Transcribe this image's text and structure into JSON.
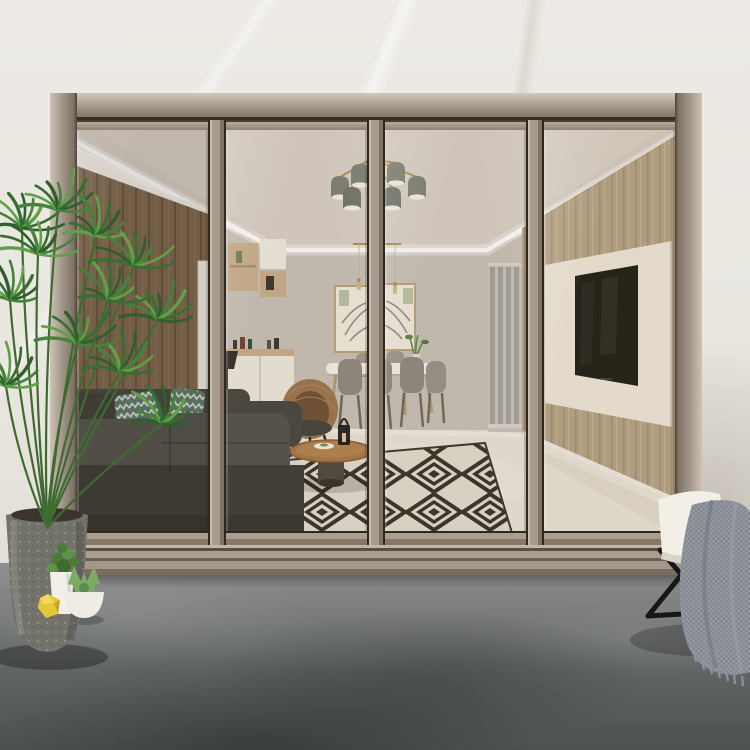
{
  "labels": {
    "scene": "Bronze aluminium four-panel sliding glass patio door looking into a modern living and dining room",
    "door_frame": "champagne bronze aluminium sliding door frame",
    "glass_panels": "tinted glass door panels",
    "living_room": "living room interior with sofa, rug, dining set, TV wall and cove-lit ceiling",
    "sofa": "dark grey fabric sofa with patterned cushions",
    "rug": "black and white geometric diamond rug",
    "dining_set": "white dining table with grey chairs and botanical wall art",
    "tv_wall": "oak panelled wall with white board and black TV",
    "chandelier": "six-shade grey and brass chandelier",
    "palm_plant": "potted areca palm on the patio",
    "small_plants": "small potted plant, succulent bowl and yellow decor",
    "patio_chair": "white-cushion chair with grey knit throw blanket",
    "patio_floor": "grey concrete patio floor",
    "exterior_wall": "light marble exterior wall"
  },
  "palette": {
    "marble_wall": "#EAE7E1",
    "frame_champagne": "#A3968A",
    "frame_highlight": "#C6BBAE",
    "track_dark": "#352D25",
    "interior_ceiling": "#D4CCC3",
    "ceiling_recess": "#D9D1C8",
    "interior_wall": "#C9C2B9",
    "cove_white": "#F4F0E8",
    "led_white": "#FFFFFF",
    "wood_left": "#8D7256",
    "wood_right": "#B5A286",
    "interior_floor": "#EAE5DB",
    "skirting": "#F1EDE4",
    "sofa_dark": "#46463F",
    "sofa_mid": "#55554C",
    "cushion_teal": "#5E7A6C",
    "rug_light": "#EFE9DD",
    "rug_dark": "#352E26",
    "table_wood": "#A87847",
    "rattan_brown": "#9A744E",
    "chair_gray": "#8F8A82",
    "art_green": "#B7C3A4",
    "tv_black": "#16160F",
    "tv_board": "#EFE9DD",
    "partition_gray": "#A2A29B",
    "concrete_light": "#909291",
    "concrete_dark": "#4D5152",
    "pot_concrete": "#74736B",
    "plant_green": "#44833A",
    "lemon_yellow": "#E6C837",
    "white_pot": "#F1EFE8",
    "blanket_gray": "#8B9099",
    "cushion_white": "#F2EFE6",
    "leg_black": "#17171A",
    "gold": "#B48B4E",
    "shade_gray": "#7A7E73"
  }
}
